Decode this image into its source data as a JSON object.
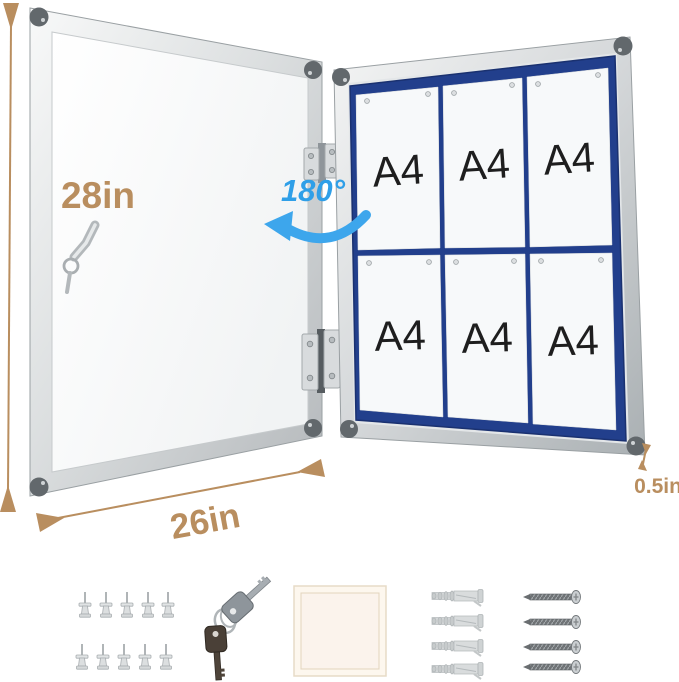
{
  "annotations": {
    "height_label": "28in",
    "width_label": "26in",
    "depth_label": "0.5in",
    "angle_label": "180°"
  },
  "board": {
    "sheet_labels": [
      "A4",
      "A4",
      "A4",
      "A4",
      "A4",
      "A4"
    ],
    "rows": 2,
    "columns": 3
  },
  "accessories": {
    "push_pins": {
      "icon_name": "push-pin-icon",
      "count": 10
    },
    "keys": {
      "icon_name": "keys-icon",
      "count": 2
    },
    "backing_panel": {
      "icon_name": "backing-panel-icon",
      "count": 1
    },
    "wall_anchors": {
      "icon_name": "wall-anchor-icon",
      "count": 4
    },
    "screws": {
      "icon_name": "screw-icon",
      "count": 4
    }
  },
  "colors": {
    "dimension_accent": "#b98e5f",
    "angle_accent": "#2f9fe8",
    "board_backing": "#223f8c"
  }
}
